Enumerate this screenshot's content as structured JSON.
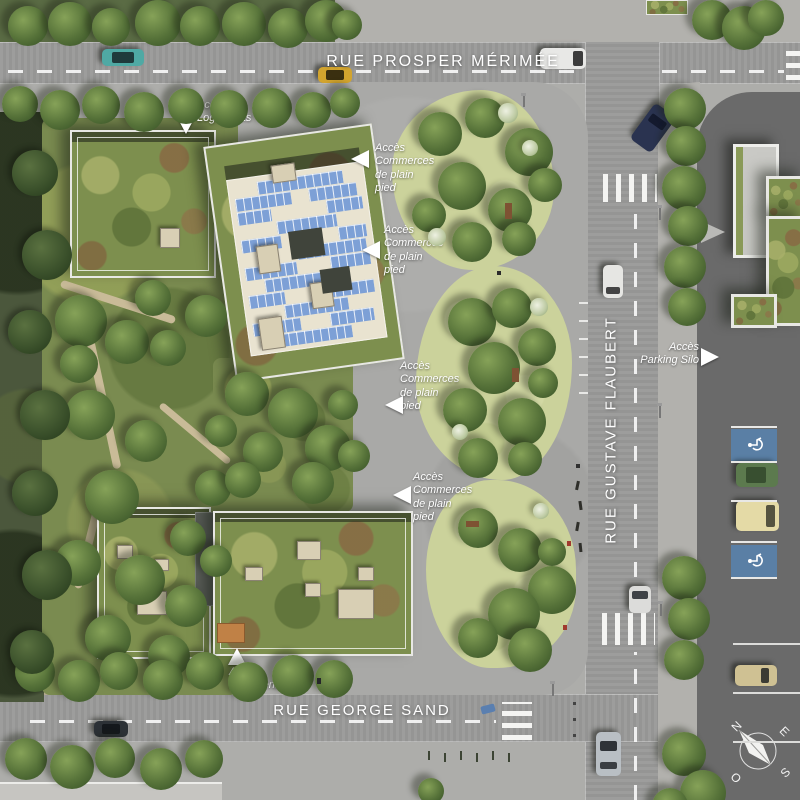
{
  "streets": {
    "top": "RUE PROSPER MÉRIMÉE",
    "right": "RUE GUSTAVE FLAUBERT",
    "bottom": "RUE GEORGE SAND"
  },
  "access_labels": {
    "logements_top": "Accès\nLogements",
    "commerces": [
      {
        "text": "Accès\nCommerces\nde plain\npied"
      },
      {
        "text": "Accès\nCommerces\nde plain\npied"
      },
      {
        "text": "Accès\nCommerces\nde plain\npied"
      },
      {
        "text": "Accès\nCommerces\nde plain\npied"
      }
    ],
    "parking_silo": "Accès\nParking Silo",
    "logements_bottom": "Accès\nLogements"
  },
  "compass": {
    "north": "N",
    "east": "E",
    "south": "S",
    "west": "O"
  },
  "colors": {
    "road_gray": "#9a9a99",
    "plaza_gray": "#a9a9a7",
    "asphalt_dark": "#6a6a6a",
    "park_green": "#7a8b50",
    "garden_light_green": "#cbd29b",
    "sedum_roof_green": "#7d8f4e",
    "solar_panel_blue": "#7da0d6",
    "handicap_blue": "#5a7fa5",
    "label_white": "#ffffff"
  }
}
